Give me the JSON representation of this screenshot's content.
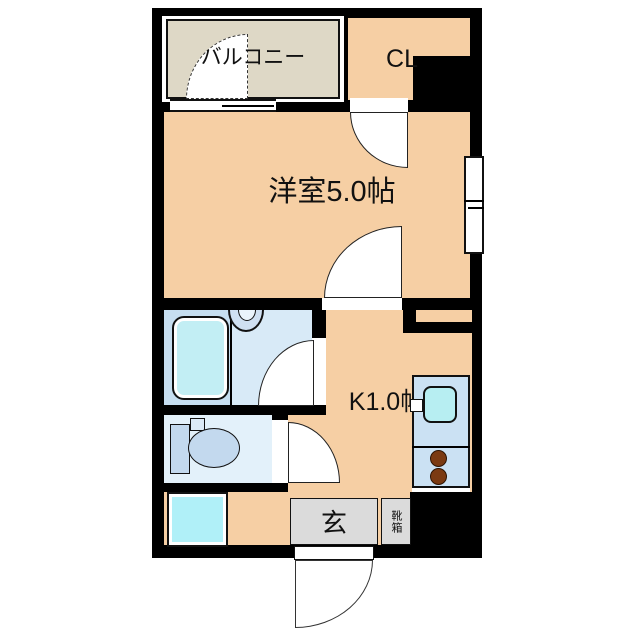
{
  "floorplan": {
    "labels": {
      "balcony": "バルコニー",
      "closet": "CL",
      "western_room": "洋室5.0帖",
      "kitchen": "K1.0帖",
      "entrance": "玄",
      "shoebox": "靴箱"
    },
    "colors": {
      "wall": "#000000",
      "room_floor": "#f6cfa4",
      "balcony_floor": "#ded8c6",
      "bathroom_floor": "#d8eaf7",
      "bathtub_zone": "#c6def0",
      "bathtub": "#c2eef4",
      "toilet_floor": "#e3f1fa",
      "fixture_blue": "#c3d9ee",
      "kitchen_counter": "#cbe1f3",
      "kitchen_sink": "#b7eef2",
      "stove_burner": "#7b3a12",
      "washer_pan": "#b0f0f8",
      "entrance_floor": "#dbdbdb",
      "label_text": "#111111",
      "background": "#ffffff"
    }
  }
}
